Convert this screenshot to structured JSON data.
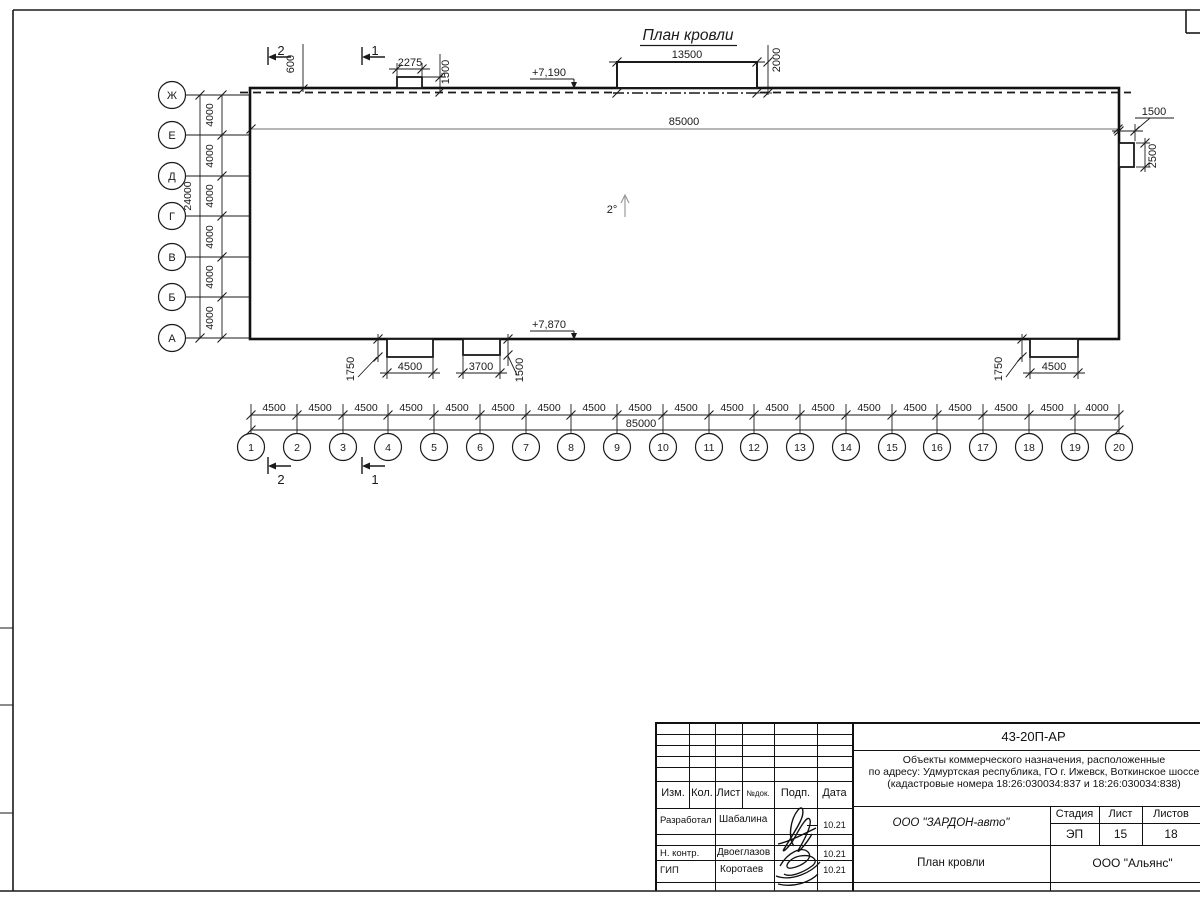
{
  "drawing": {
    "title": "План кровли",
    "slope_label": "2°",
    "ridge_dim": "85000",
    "elevation_top": "+7,190",
    "elevation_bottom": "+7,870",
    "section_mark_1": "1",
    "section_mark_2": "2",
    "dim_600": "600",
    "top_box_small": {
      "width": "2275",
      "height": "1500"
    },
    "top_box_large": {
      "width": "13500",
      "height": "2000"
    },
    "right_box": {
      "width": "1500",
      "height": "2500"
    },
    "bottom_box_1": {
      "width": "4500",
      "height": "1750"
    },
    "bottom_box_2": {
      "width": "3700",
      "height": "1500"
    },
    "bottom_box_3": {
      "width": "4500",
      "height": "1750"
    },
    "v_axes": {
      "labels": [
        "Ж",
        "Е",
        "Д",
        "Г",
        "В",
        "Б",
        "А"
      ],
      "spacing_typ": "4000",
      "total": "24000"
    },
    "h_axes": {
      "labels": [
        "1",
        "2",
        "3",
        "4",
        "5",
        "6",
        "7",
        "8",
        "9",
        "10",
        "11",
        "12",
        "13",
        "14",
        "15",
        "16",
        "17",
        "18",
        "19",
        "20"
      ],
      "spacing_typ": "4500",
      "spacing_last": "4000",
      "total": "85000"
    }
  },
  "title_block": {
    "doc_code": "43-20П-АР",
    "project_line1": "Объекты коммерческого назначения, расположенные",
    "project_line2": "по адресу: Удмуртская республика, ГО г. Ижевск, Воткинское шоссе",
    "project_line3": "(кадастровые номера 18:26:030034:837 и 18:26:030034:838)",
    "col_izm": "Изм.",
    "col_kol": "Кол.",
    "col_list": "Лист",
    "col_ndok": "№док.",
    "col_podp": "Подп.",
    "col_data": "Дата",
    "rows": [
      {
        "role": "Разработал",
        "name": "Шабалина",
        "date": "10.21"
      },
      {
        "role": "Н. контр.",
        "name": "Двоеглазов",
        "date": "10.21"
      },
      {
        "role": "ГИП",
        "name": "Коротаев",
        "date": "10.21"
      }
    ],
    "company": "ООО \"ЗАРДОН-авто\"",
    "stage_label": "Стадия",
    "stage": "ЭП",
    "sheet_label": "Лист",
    "sheet": "15",
    "sheets_label": "Листов",
    "sheets": "18",
    "sheet_title": "План кровли",
    "contractor": "ООО \"Альянс\""
  }
}
